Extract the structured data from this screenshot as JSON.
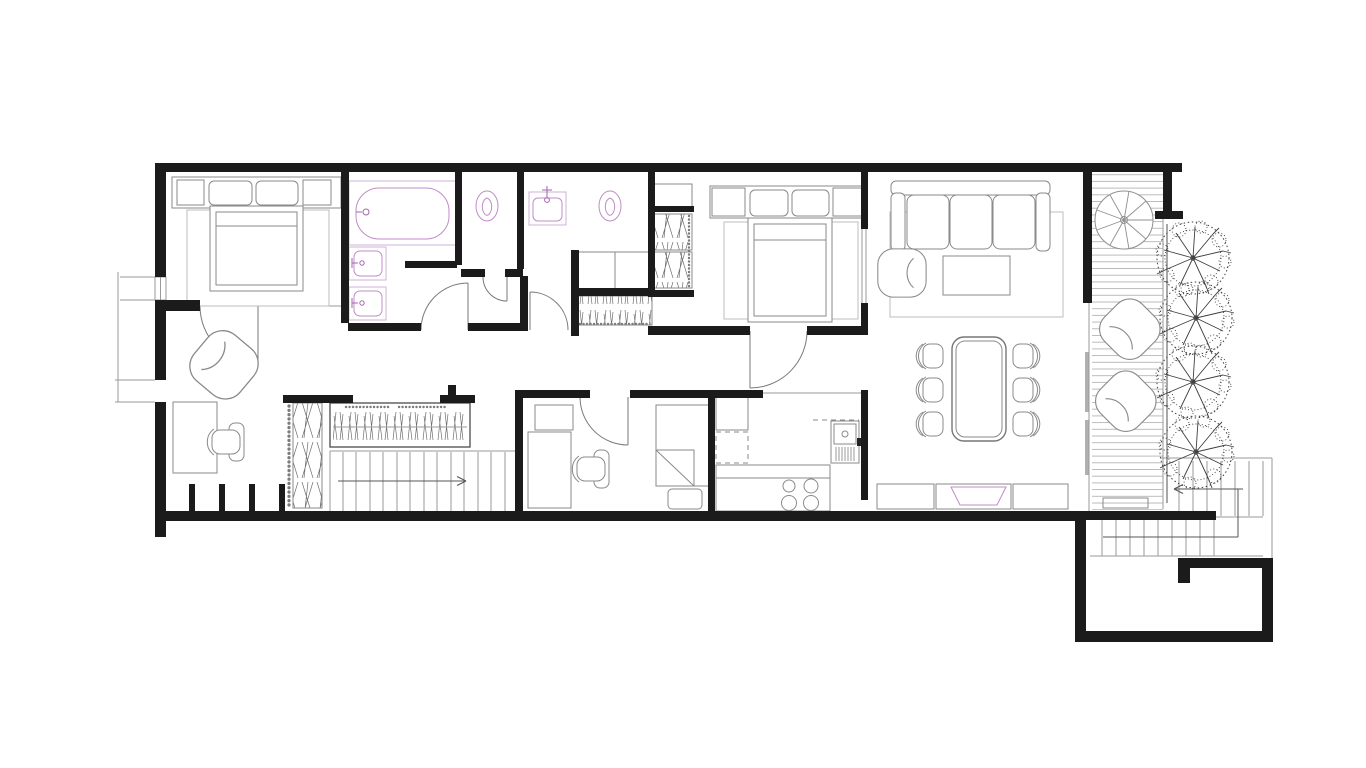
{
  "document": {
    "type": "architectural floor plan",
    "view": "top-down plan of an elongated apartment with side terrace",
    "visible_text": "none",
    "drawing_style": "CAD linework: black walls, gray furniture outlines, pink plumbing fixtures"
  },
  "colors": {
    "background": "#ffffff",
    "wall": "#1b1b1b",
    "furniture_line": "#8a8a8a",
    "light_line": "#bdbdbd",
    "structure_line": "#9a9a9a",
    "hatch_line": "#6e6e6e",
    "deck_line": "#ababab",
    "tree": "#3f3f3f",
    "plumbing": "#c08cc8",
    "plumbing_light": "#d2b0d8",
    "plumbing_accent": "#a265ae"
  },
  "rooms": [
    {
      "id": "master-bedroom",
      "position": "top-left",
      "furniture": [
        "double bed",
        "two pillows",
        "headboard side cabinets",
        "area rug"
      ]
    },
    {
      "id": "master-bathroom",
      "position": "top, left of center",
      "fixtures": [
        "bathtub",
        "washbasin",
        "washbasin"
      ]
    },
    {
      "id": "wc",
      "position": "top center",
      "fixtures": [
        "toilet"
      ]
    },
    {
      "id": "second-bathroom",
      "position": "top center",
      "fixtures": [
        "wall-hung washbasin",
        "toilet"
      ],
      "furniture": [
        "bench cabinet",
        "hall wardrobe"
      ]
    },
    {
      "id": "second-bedroom",
      "position": "top, right of center",
      "furniture": [
        "double bed",
        "two pillows",
        "wardrobe with hanging clothes",
        "area rug"
      ]
    },
    {
      "id": "living-room",
      "position": "right",
      "furniture": [
        "three-seat sofa",
        "armchair",
        "coffee table",
        "area rug",
        "sideboard with basin"
      ]
    },
    {
      "id": "dining-area",
      "position": "right, below living room",
      "furniture": [
        "dining table",
        "six dining chairs"
      ]
    },
    {
      "id": "kitchen",
      "position": "bottom center-right",
      "fixtures": [
        "four-burner cooktop",
        "sink unit"
      ],
      "furniture": [
        "cabinet column",
        "counter",
        "overhead cabinets shown dashed"
      ]
    },
    {
      "id": "study-guest-room",
      "position": "bottom center",
      "furniture": [
        "desk",
        "cabinet",
        "office chair",
        "single bed",
        "nightstand"
      ]
    },
    {
      "id": "office-nook",
      "position": "bottom left",
      "furniture": [
        "desk",
        "office chair",
        "armchair",
        "shelf bays",
        "hatched wardrobe"
      ]
    },
    {
      "id": "hallway",
      "position": "center, full width",
      "furniture": [
        "planter with grasses"
      ]
    },
    {
      "id": "terrace",
      "position": "right edge",
      "features": [
        "wood plank decking",
        "spiral staircase",
        "two lounge chairs",
        "four trees",
        "step mat"
      ]
    }
  ],
  "stairs": [
    {
      "id": "internal-staircase",
      "location": "bottom left of hallway",
      "treads": 13,
      "direction_arrow": "points right"
    },
    {
      "id": "spiral-staircase",
      "location": "terrace top nook"
    },
    {
      "id": "external-staircase",
      "location": "bottom right",
      "flights": 2,
      "direction_arrow": "points left"
    }
  ],
  "doors": [
    {
      "id": "master-bedroom-door",
      "swing": "into hallway"
    },
    {
      "id": "master-bathroom-door",
      "swing": "into bathroom"
    },
    {
      "id": "wc-door",
      "swing": "into hallway"
    },
    {
      "id": "second-bathroom-door",
      "swing": "into bathroom"
    },
    {
      "id": "second-bedroom-door",
      "swing": "into hallway"
    },
    {
      "id": "study-door",
      "swing": "into room"
    },
    {
      "id": "terrace-sliding-door",
      "type": "sliding"
    }
  ],
  "windows": [
    {
      "id": "window-upper",
      "wall": "left"
    },
    {
      "id": "entry-opening",
      "wall": "left"
    }
  ],
  "counts": {
    "bedrooms": 2,
    "bathrooms": 2,
    "toilets": 2,
    "washbasins": 3,
    "bathtubs": 1,
    "dining_chairs": 6,
    "lounge_chairs": 2,
    "trees": 4,
    "sofa_seats": 3,
    "cooktop_burners": 4
  }
}
